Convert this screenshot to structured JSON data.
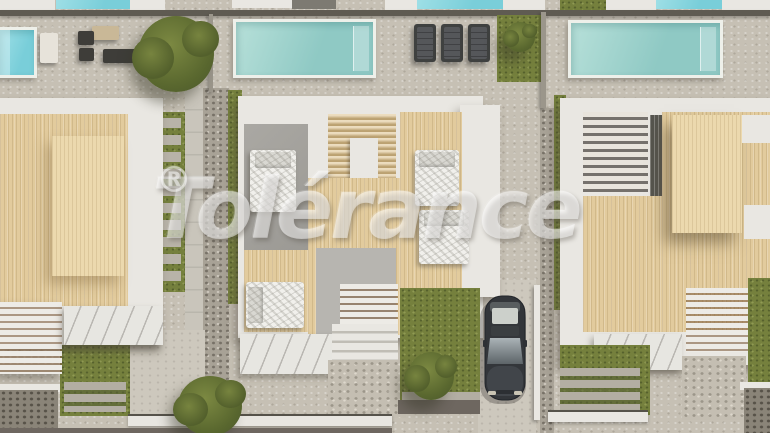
{
  "watermark": {
    "text": "Tolérance",
    "registered": "®"
  },
  "scene": {
    "kind": "aerial-architectural-render",
    "subject": "Top-down render of a row of three modern villas, each with a private pool terrace, wooden roof decks and pergolas, a cutaway bedroom floor plan in the middle villa, lawns, stone paths, trees and one dark parked car"
  },
  "palette": {
    "paving": "#c6c0b4",
    "white_roof": "#e9e7e2",
    "wood": "#e2cb9d",
    "wood_light": "#ecd9ae",
    "grass": "#75803d",
    "pool_teal_1": "#b7e0d9",
    "pool_teal_2": "#8fc9c4",
    "pool_cyan": "#79ced9",
    "pool_border": "#eef0ea",
    "furniture": "#3e3d39",
    "car_body": "#33363a",
    "watermark_white": "#ffffff"
  }
}
